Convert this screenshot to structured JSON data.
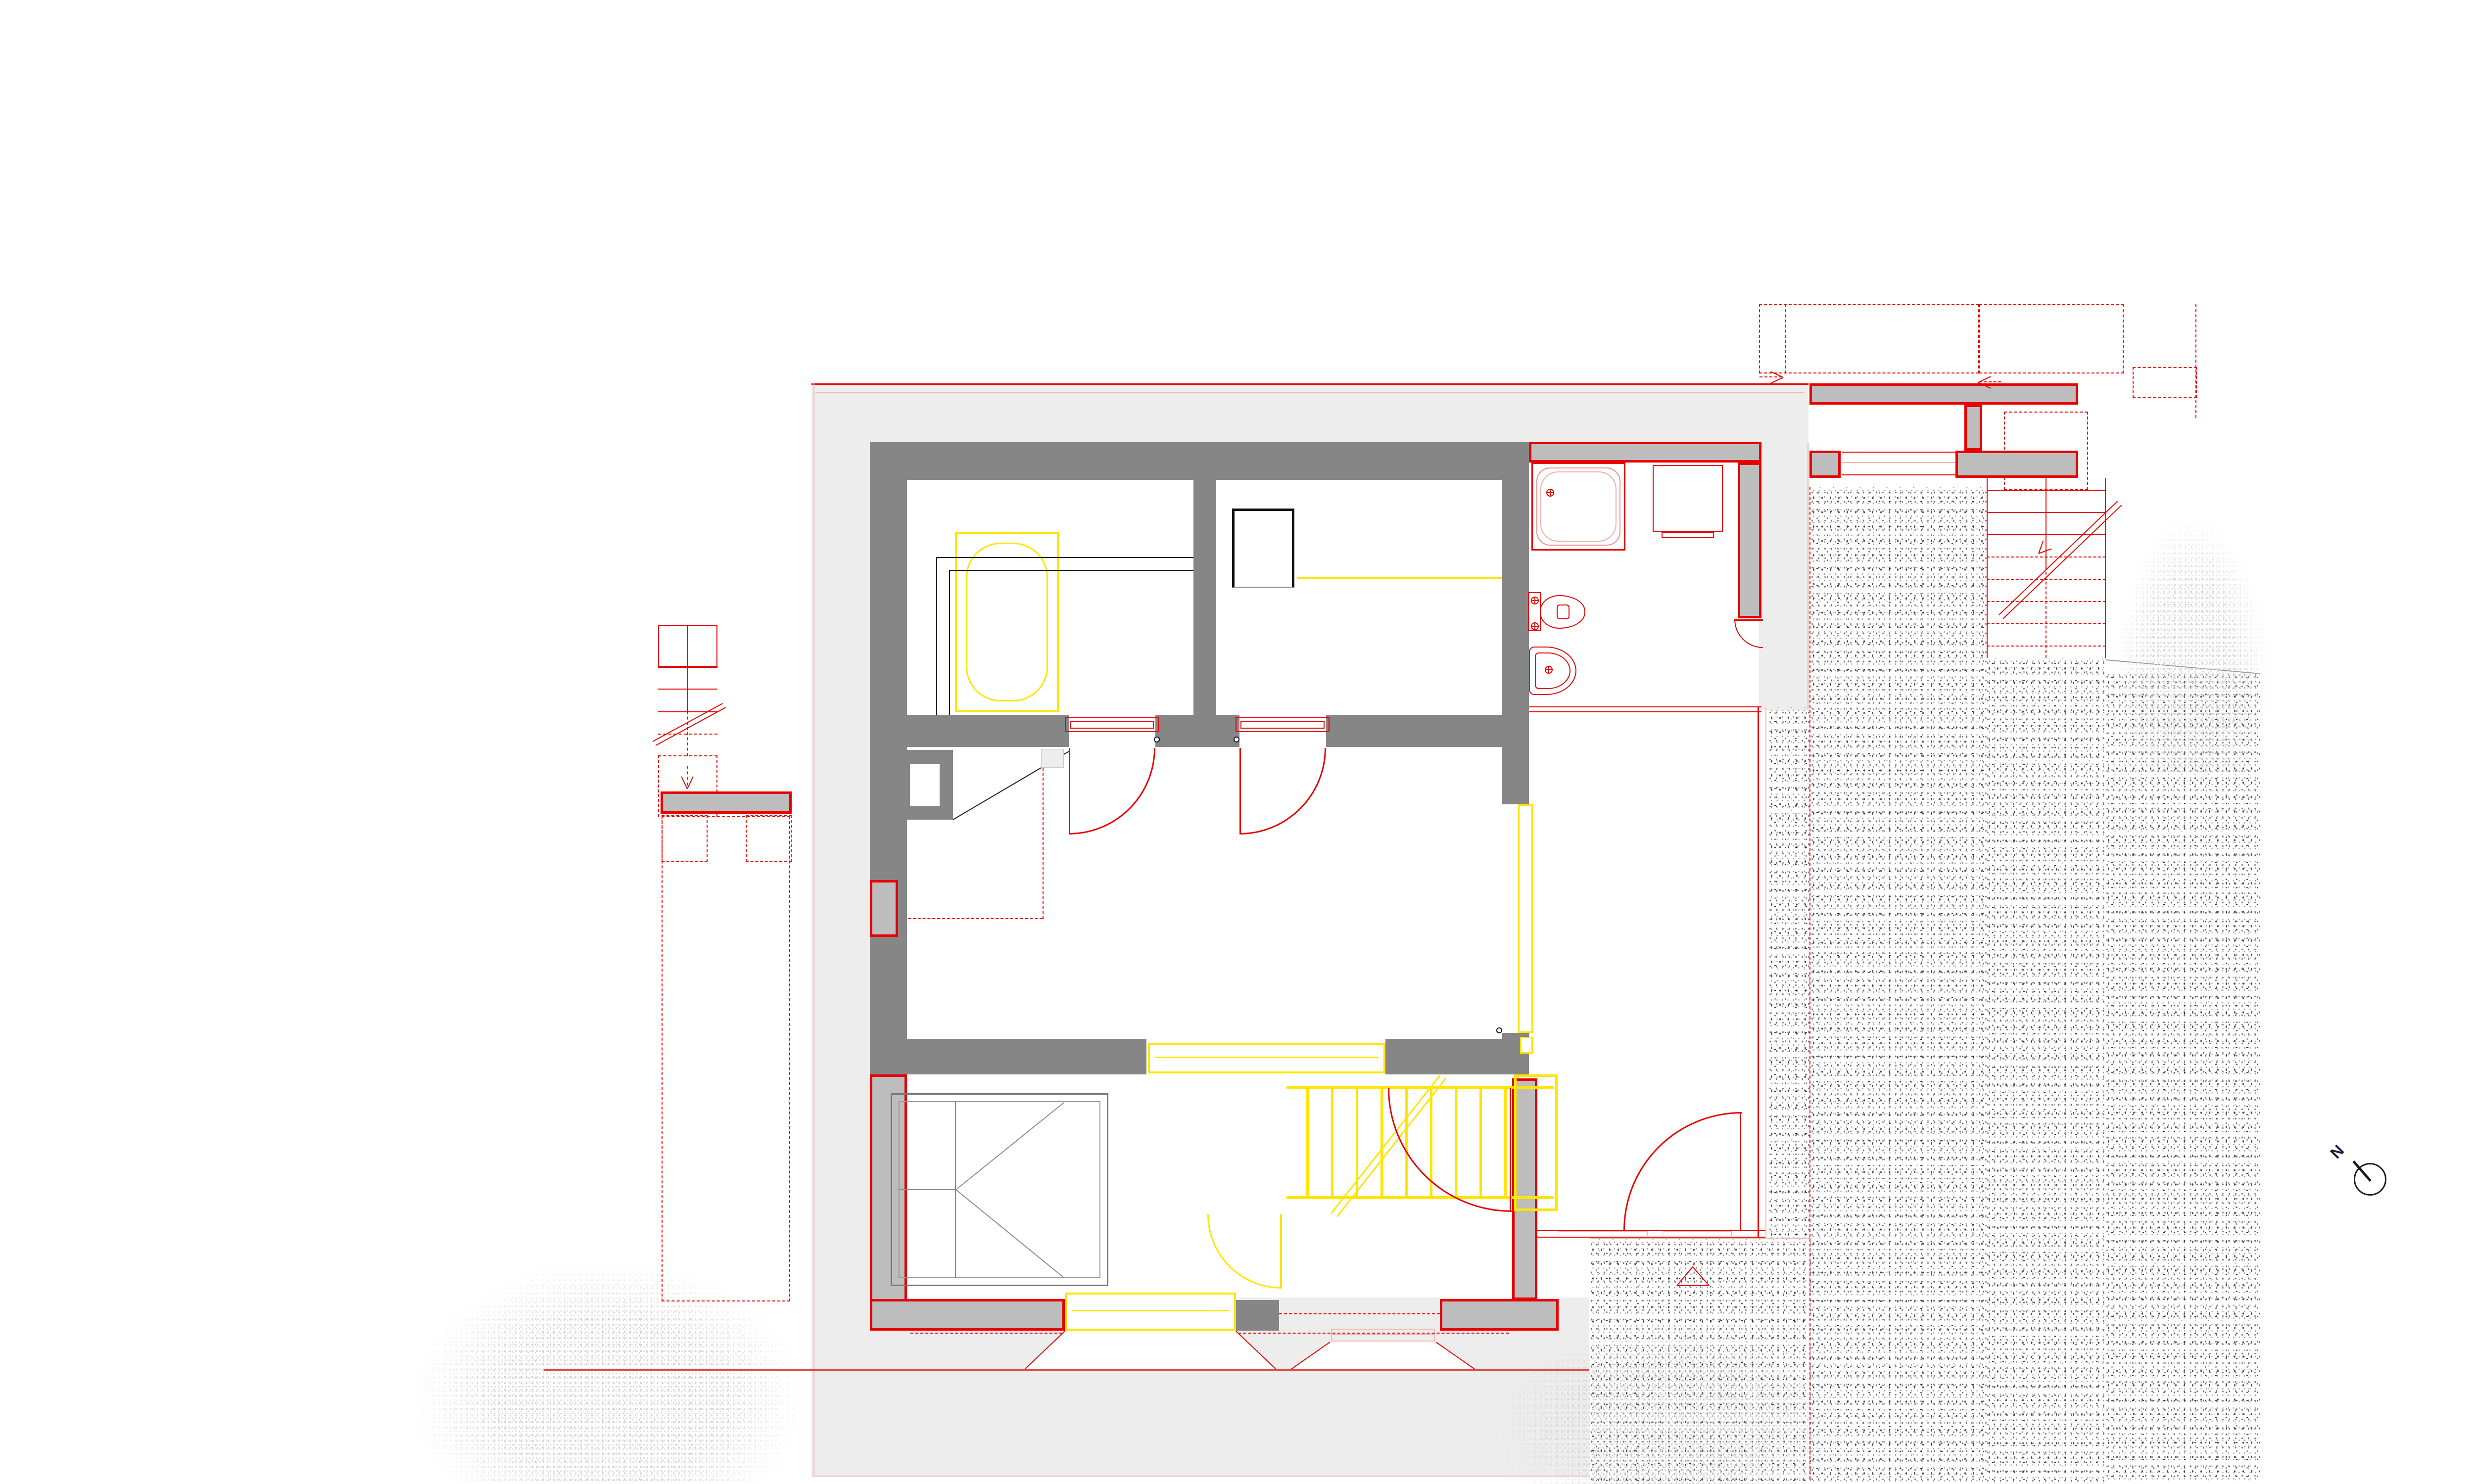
{
  "document": {
    "kind": "architectural-floor-plan",
    "visible_text": [
      "N"
    ]
  },
  "north": {
    "label": "N"
  },
  "palette": {
    "paper": "#ffffff",
    "wall-existing": "#868686",
    "wall-new-fill": "#bdbdbd",
    "red": "#e60000",
    "red-soft": "#dd4b43",
    "pink": "#f2b7b2",
    "yellow": "#ffe500",
    "surface": "#ededed",
    "tree": "#d2d2d2",
    "stipple-dark": "#2e2e2e",
    "stipple-mid": "#6b6b6b",
    "ink": "#161e3c"
  },
  "symbols": {
    "north_arrow": "circle with needle pointing north-west",
    "entrance_marker": "red outline triangle",
    "stair_direction": "diagonal cut line with arrow",
    "door_swing": "quarter-circle arc",
    "demolition_or_projection": "red dashed outline",
    "new_construction": "gray wall with red outline",
    "new_fixture": "yellow outline",
    "terrain": "random dot stipple",
    "vegetation": "light gray speckle tree silhouette"
  }
}
